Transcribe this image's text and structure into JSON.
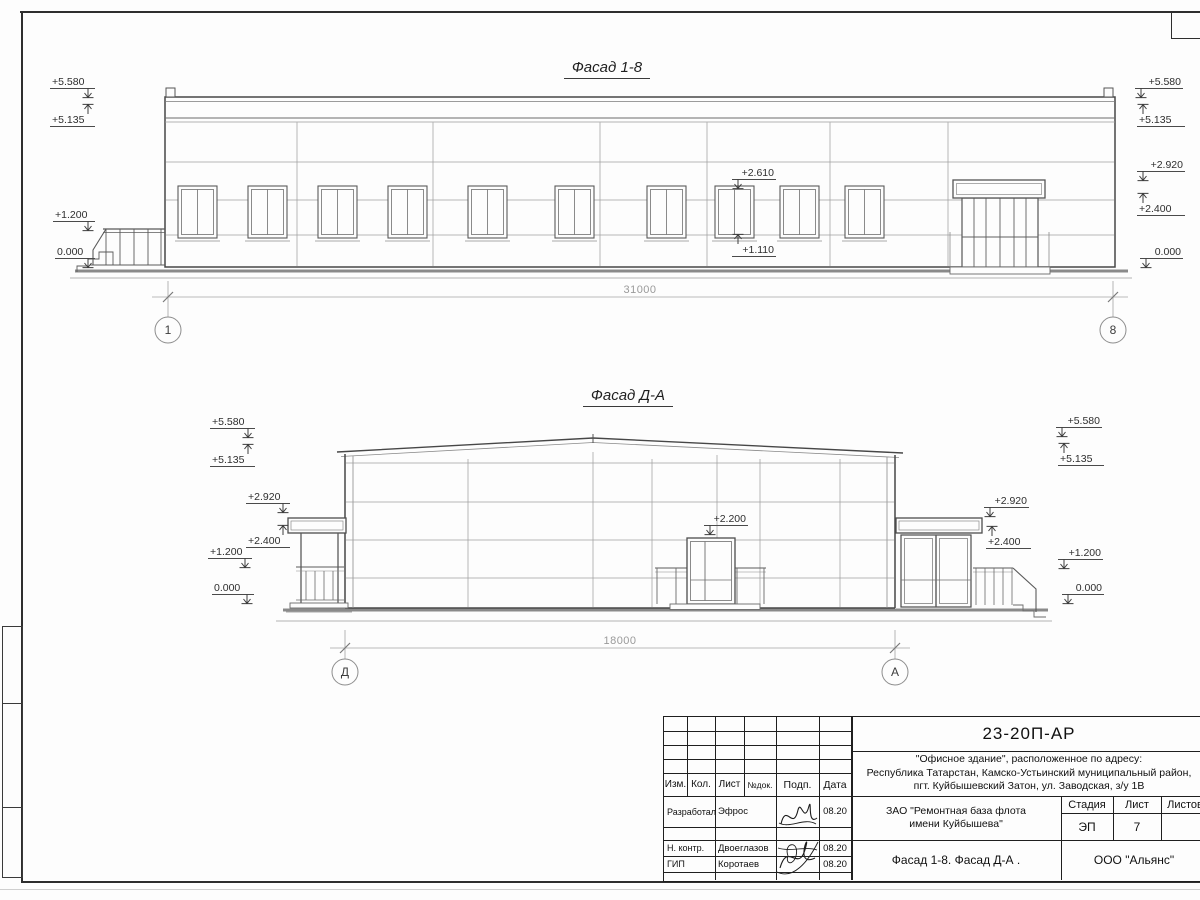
{
  "colors": {
    "ink": "#3f3f3f",
    "light_line": "#9c9c9c",
    "dim_text": "#9a9a9a",
    "ground_line": "#8a8a8a"
  },
  "facade1": {
    "title": "Фасад 1-8",
    "dimension": "31000",
    "axis_left": "1",
    "axis_right": "8",
    "marks_left": [
      {
        "value": "+5.580",
        "dir": "down"
      },
      {
        "value": "+5.135",
        "dir": "up"
      },
      {
        "value": "+1.200",
        "dir": "down"
      },
      {
        "value": "0.000",
        "dir": "down"
      }
    ],
    "marks_right": [
      {
        "value": "+5.580",
        "dir": "down"
      },
      {
        "value": "+5.135",
        "dir": "up"
      },
      {
        "value": "+2.920",
        "dir": "down"
      },
      {
        "value": "+2.400",
        "dir": "up"
      },
      {
        "value": "0.000",
        "dir": "down"
      }
    ],
    "window_callout_top": "+2.610",
    "window_callout_bottom": "+1.110"
  },
  "facade2": {
    "title": "Фасад Д-А",
    "dimension": "18000",
    "axis_left": "Д",
    "axis_right": "А",
    "marks_left": [
      {
        "value": "+5.580",
        "dir": "down"
      },
      {
        "value": "+5.135",
        "dir": "up"
      },
      {
        "value": "+2.920",
        "dir": "down"
      },
      {
        "value": "+2.400",
        "dir": "up"
      },
      {
        "value": "+1.200",
        "dir": "down"
      },
      {
        "value": "0.000",
        "dir": "down"
      }
    ],
    "marks_right": [
      {
        "value": "+5.580",
        "dir": "down"
      },
      {
        "value": "+5.135",
        "dir": "up"
      },
      {
        "value": "+2.920",
        "dir": "down"
      },
      {
        "value": "+2.400",
        "dir": "up"
      },
      {
        "value": "+1.200",
        "dir": "down"
      },
      {
        "value": "0.000",
        "dir": "down"
      }
    ],
    "door_callout": "+2.200"
  },
  "titleblock": {
    "code": "23-20П-АР",
    "project_lines": [
      "\"Офисное здание\", расположенное по адресу:",
      "Республика Татарстан, Камско-Устьинский муниципальный район,",
      "пгт. Куйбышевский Затон, ул. Заводская, з/у 1В"
    ],
    "client_lines": [
      "ЗАО \"Ремонтная база флота",
      "имени Куйбышева\""
    ],
    "sheet_title": "Фасад 1-8. Фасад Д-А .",
    "organization": "ООО \"Альянс\"",
    "stage_label": "Стадия",
    "sheet_label": "Лист",
    "sheets_label": "Листов",
    "stage_value": "ЭП",
    "sheet_value": "7",
    "columns": [
      "Изм.",
      "Кол.",
      "Лист",
      "№док.",
      "Подп.",
      "Дата"
    ],
    "rows": [
      {
        "role": "Разработал",
        "name": "Эфрос",
        "date": "08.20"
      },
      {
        "role": "Н. контр.",
        "name": "Двоеглазов",
        "date": "08.20"
      },
      {
        "role": "ГИП",
        "name": "Коротаев",
        "date": "08.20"
      }
    ]
  }
}
